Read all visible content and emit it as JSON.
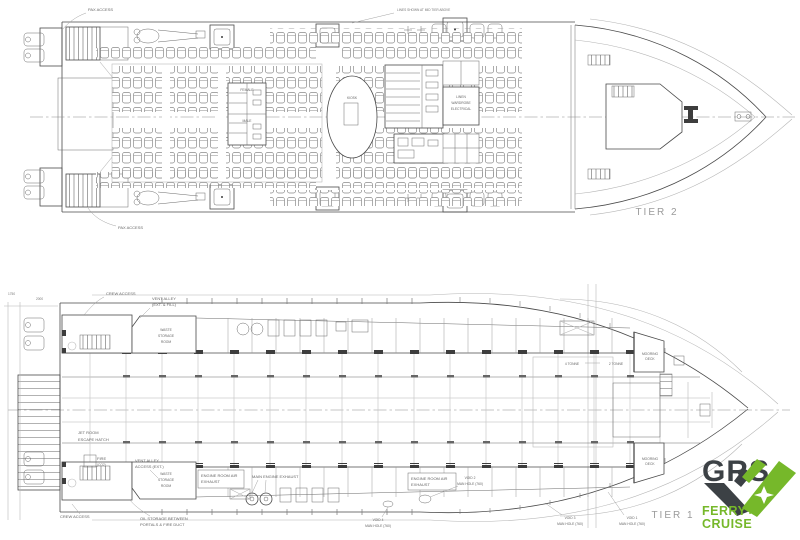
{
  "drawing": {
    "tier2": {
      "name": "TIER 2",
      "labels": {
        "pax_access_top": "PAX ACCESS",
        "pax_access_bottom": "PAX ACCESS",
        "top_note": "LINES SHOWN AT MID TIER ABOVE",
        "female": "FEMALE",
        "male": "MALE",
        "kiosk": "KIOSK",
        "store_room": [
          "LINEN",
          "WARDROBE",
          "ELECTRICAL"
        ]
      }
    },
    "tier1": {
      "name": "TIER 1",
      "labels": {
        "crew_access_top": "CREW ACCESS",
        "crew_access_bottom": "CREW ACCESS",
        "vent_alley_fill": [
          "VENT ALLEY",
          "(EXT. & FILL)"
        ],
        "vent_alley_access": [
          "VENT ALLEY",
          "ACCESS (EXT.)"
        ],
        "jet_room": [
          "JET ROOM",
          "ESCAPE HATCH"
        ],
        "fire": [
          "FIRE",
          "(CO2)"
        ],
        "oil_storage": [
          "OIL STORAGE BETWEEN",
          "PORTALS & FIRE DUCT"
        ],
        "er_air_exhaust_left": [
          "ENGINE ROOM AIR",
          "EXHAUST"
        ],
        "er_air_exhaust_right": [
          "ENGINE ROOM AIR",
          "EXHAUST"
        ],
        "main_engine_exhaust": "MAIN ENGINE EXHAUST",
        "store_room_top": [
          "WASTE",
          "STORAGE",
          "ROOM"
        ],
        "store_room_bottom": [
          "WASTE",
          "STORAGE",
          "ROOM"
        ],
        "mooring_deck": [
          "MOORING",
          "DECK"
        ],
        "tonne_4": "4 TONNE",
        "tonne_2": "2 TONNE",
        "dim_1750": "1750",
        "dim_2000": "2000"
      },
      "voids": [
        {
          "name": "VOID 2",
          "detail": "MAN HOLE (760)"
        },
        {
          "name": "VOID 4",
          "detail": "MAN HOLE (760)"
        },
        {
          "name": "VOID 3",
          "detail": "MAN HOLE (760)"
        },
        {
          "name": "VOID 1",
          "detail": "MAN HOLE (760)"
        }
      ]
    },
    "logo": {
      "brand": "GRS",
      "tagline": [
        "FERRY+",
        "CRUISE"
      ]
    },
    "colors": {
      "line": "#4a4a4a",
      "light_line": "#b4b4b4",
      "label": "#666666",
      "tier_label": "#9a9a9a",
      "logo_dark": "#3c4145",
      "logo_green": "#76b82a"
    }
  }
}
